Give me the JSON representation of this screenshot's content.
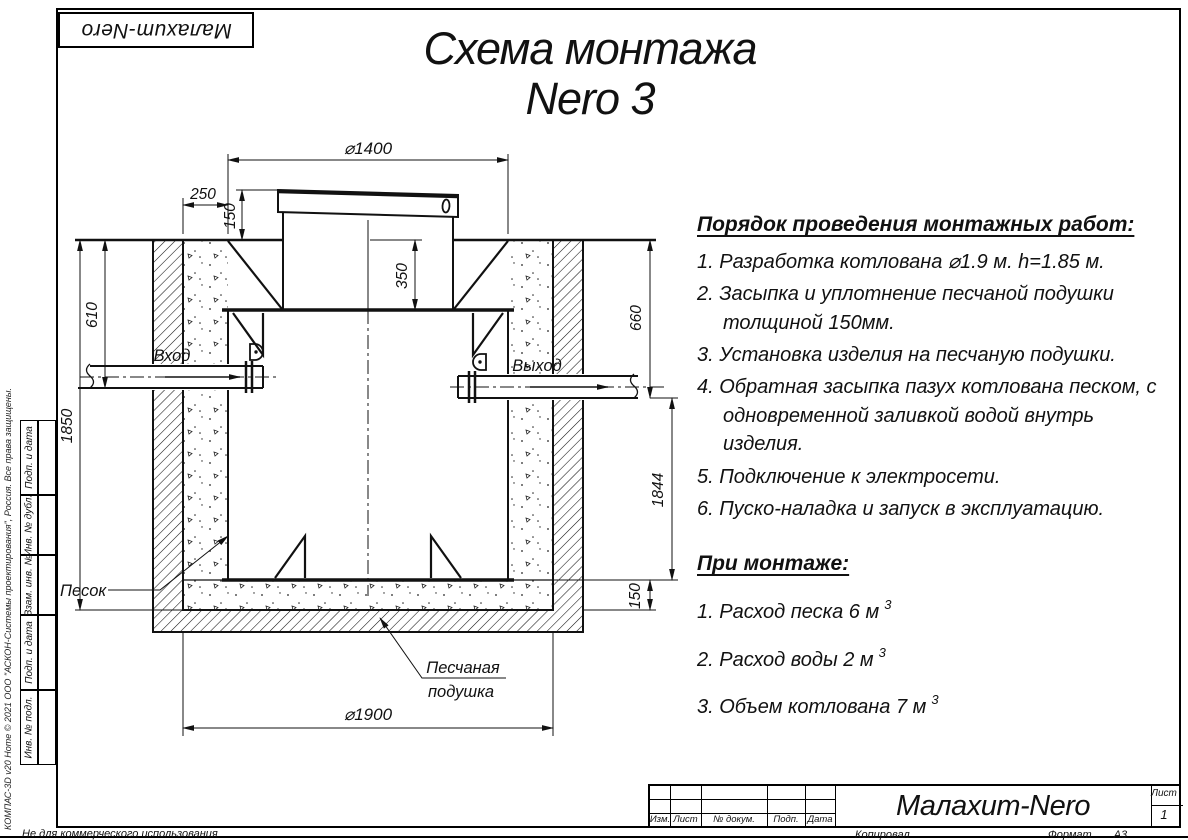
{
  "page": {
    "logo": "Малахит-Nero",
    "copyright": "КОМПАС-3D v20 Home © 2021 ООО \"АСКОН-Системы проектирования\", Россия. Все права защищены.",
    "footer_left": "Не для коммерческого использования",
    "footer_copied": "Копировал",
    "format_label": "Формат",
    "format_value": "А3"
  },
  "title": {
    "line1": "Схема монтажа",
    "line2": "Nero 3"
  },
  "sidebar": {
    "cells": [
      "Подп. и дата",
      "Инв. № дубл.",
      "Взам. инв. №",
      "Подп. и дата",
      "Инв. № подл."
    ]
  },
  "instructions": {
    "heading": "Порядок проведения монтажных работ:",
    "items": [
      "1. Разработка котлована ⌀1.9 м. h=1.85 м.",
      "2. Засыпка и уплотнение песчаной подушки толщиной 150мм.",
      "3. Установка изделия на песчаную подушки.",
      "4. Обратная засыпка пазух котлована песком, с одновременной заливкой водой внутрь изделия.",
      "5. Подключение к электросети.",
      "6. Пуско-наладка и запуск в эксплуатацию."
    ],
    "heading2": "При монтаже:",
    "items2": [
      {
        "text": "1. Расход песка 6 м",
        "sup": "3"
      },
      {
        "text": "2. Расход воды 2 м",
        "sup": "3"
      },
      {
        "text": "3. Объем котлована 7 м",
        "sup": "3"
      }
    ]
  },
  "drawing": {
    "dims": {
      "d1400": "⌀1400",
      "d250": "250",
      "d150_top": "150",
      "d350": "350",
      "d610": "610",
      "d1850": "1850",
      "d660": "660",
      "d1844": "1844",
      "d150_bottom": "150",
      "d1900": "⌀1900"
    },
    "labels": {
      "inlet": "Вход",
      "outlet": "Выход",
      "sand": "Песок",
      "cushion1": "Песчаная",
      "cushion2": "подушка"
    }
  },
  "title_block": {
    "columns": [
      "Изм.",
      "Лист",
      "№ докум.",
      "Подп.",
      "Дата"
    ],
    "product": "Малахит-Nero",
    "sheet_label": "Лист",
    "sheet_value": "1"
  }
}
